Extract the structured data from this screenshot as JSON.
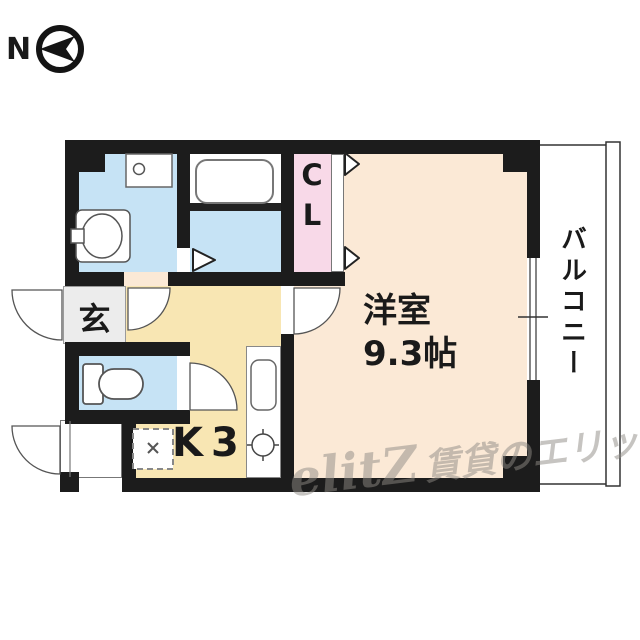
{
  "compass": {
    "label": "N"
  },
  "rooms": {
    "entrance": {
      "label": "玄"
    },
    "kitchen": {
      "label": "K3"
    },
    "closet": {
      "label": "CL"
    },
    "main_room": {
      "label": "洋室",
      "size": "9.3帖"
    },
    "balcony": {
      "label": "バルコニー"
    }
  },
  "watermark": {
    "logo": "elitZ",
    "text": "賃貸のエリッツ"
  },
  "colors": {
    "wall": "#1c1c1c",
    "wet_area": "#c6e3f5",
    "closet": "#f8d9e8",
    "main_room": "#fbe9d6",
    "kitchen": "#f8e6b3",
    "entrance": "#ececec",
    "watermark_gray": "#8f8b85"
  },
  "icons": {
    "compass-arrow-icon": "black left-pointing arrow inside black ring",
    "washing-machine-pan-icon": "white square with drain circle",
    "washbasin-icon": "rounded square with oval bowl and tap",
    "bathtub-icon": "rounded rectangle tub",
    "toilet-icon": "tank with rounded bowl pointing right",
    "kitchen-sink-icon": "rounded rectangle sink in counter strip",
    "stove-burner-icon": "circle with four tick marks",
    "gas-stove-space-icon": "dashed square with small x",
    "door-arc-icon": "quarter-circle swing arc",
    "folding-door-icon": "right-pointing triangle",
    "window-icon": "double thin lines in wall gap"
  }
}
